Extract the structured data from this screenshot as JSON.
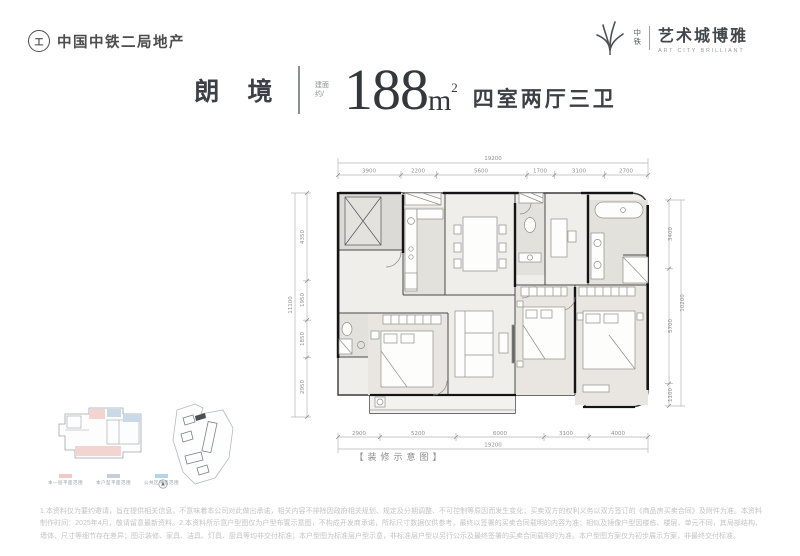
{
  "brand": {
    "left": {
      "emblem_glyph": "工",
      "name": "中国中铁二局地产"
    },
    "right": {
      "small_1": "中",
      "small_2": "铁",
      "name": "艺术城博雅",
      "en": "ART CITY BRILLIANT"
    }
  },
  "icons": {
    "left_emblem": "railway-emblem-icon",
    "right_mark": "leaf-fan-icon",
    "compass": "compass-icon"
  },
  "title": {
    "name": "朗 境",
    "area_label_1": "建面",
    "area_label_2": "约/",
    "area": "188",
    "unit": "m",
    "sup": "2",
    "rooms": "四室两厅三卫"
  },
  "plan": {
    "caption": "【装修示意图】",
    "dims": {
      "top_total": "19200",
      "top_segs": [
        "3900",
        "2200",
        "5600",
        "1700",
        "3100",
        "2700"
      ],
      "bottom_segs": [
        "2900",
        "5200",
        "6000",
        "3100",
        "4000"
      ],
      "bottom_total": "19200",
      "left_total": "11100",
      "left_segs": [
        "4350",
        "1950",
        "1850",
        "2950"
      ],
      "right_total": "10200",
      "right_segs": [
        "3400",
        "5700",
        "1100"
      ]
    }
  },
  "legend": {
    "items": [
      {
        "label": "本一层平面范围",
        "color": "#f0c8c4"
      },
      {
        "label": "本户型平面范围",
        "color": "#c6cfd6"
      },
      {
        "label": "公共区平面范围",
        "color": "#b5d4ea"
      }
    ]
  },
  "colors": {
    "accent_dark": "#34383d",
    "wall": "#1c1c1c",
    "dim_line": "#b5b5b5",
    "tile": "#e3e1dc"
  },
  "disclaimer": "1.本资料仅为要约邀请，旨在提供相关信息，不意味着本公司对此做出承诺，相关内容不排除因政府相关规划、规定及分期调整、不可控制等原因而发生变化；买卖双方的权利义务以双方签订的《商品房买卖合同》及附件为准。本资料制作时间：2025年4月，敬请留意最新资料。2.本资料所示意户型图仅为户型布置示意图，不构成开发商承诺，所标尺寸数据仅供参考，最终以签署的买卖合同载明的内容为准；相似及镜像户型因楼栋、楼层、单元不同，其局部结构、墙体、尺寸等细节存在差异；图示装修、家具、洁具、灯具、厨具等均非交付标准；本户型图为标准层户型示意，非标准层户型以另行公示及最终签署的买卖合同载明的为准。本户型图方案仅为初步展示方案，非最终交付标准。"
}
